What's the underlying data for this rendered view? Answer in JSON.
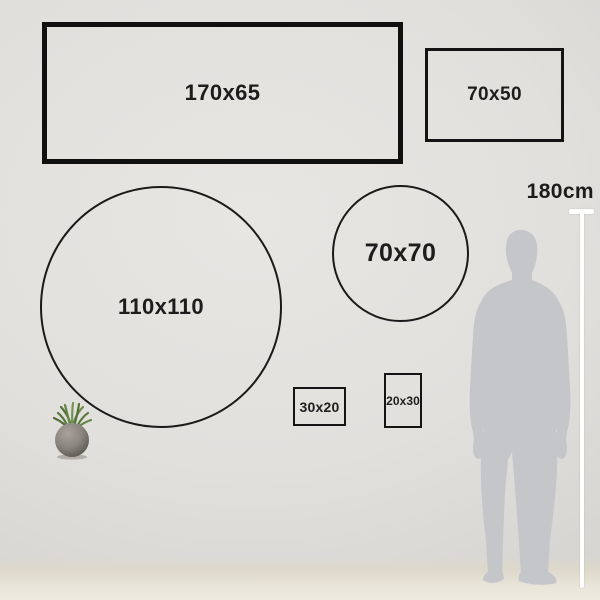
{
  "frames": [
    {
      "id": "rect_170x65",
      "shape": "rectangle",
      "label": "170x65",
      "width_cm": 170,
      "height_cm": 65
    },
    {
      "id": "rect_70x50",
      "shape": "rectangle",
      "label": "70x50",
      "width_cm": 70,
      "height_cm": 50
    },
    {
      "id": "circle_110x110",
      "shape": "circle",
      "label": "110x110",
      "width_cm": 110,
      "height_cm": 110
    },
    {
      "id": "circle_70x70",
      "shape": "circle",
      "label": "70x70",
      "width_cm": 70,
      "height_cm": 70
    },
    {
      "id": "rect_30x20",
      "shape": "rectangle",
      "label": "30x20",
      "width_cm": 30,
      "height_cm": 20
    },
    {
      "id": "rect_20x30",
      "shape": "rectangle",
      "label": "20x30",
      "width_cm": 20,
      "height_cm": 30
    }
  ],
  "measure": {
    "person_height_label": "180cm",
    "person_height_cm": 180
  },
  "colors": {
    "outline": "#141414",
    "label_text": "#1d1d1d",
    "measure_line": "#ffffff",
    "silhouette": "#c5c6ca",
    "wall": "#e2e0dd",
    "floor": "#eae5da",
    "wood": "#e9dfc6",
    "plinth": "#3a3734",
    "plant_green": "#5d7a3e",
    "pot_gray": "#8b8680"
  }
}
